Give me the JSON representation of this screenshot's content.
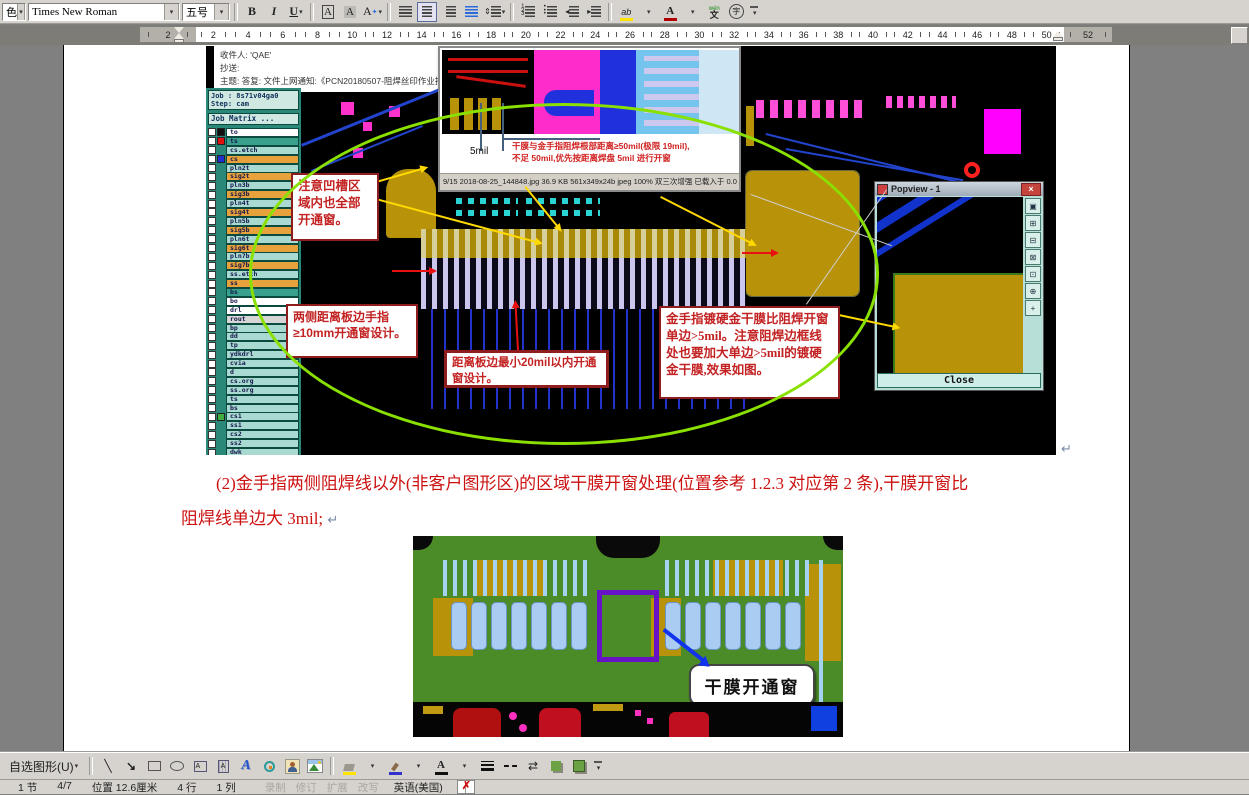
{
  "format_toolbar": {
    "style_partial": "色",
    "font_name": "Times New Roman",
    "font_size": "五号"
  },
  "icons": {
    "dropdown": "▾",
    "bold": "B",
    "italic": "I",
    "underline": "U",
    "char_border": "A",
    "char_shading": "A",
    "char_scale": "A",
    "highlight": "ab",
    "font_color": "A",
    "pinyin_top": "wén",
    "pinyin_bottom": "文",
    "enclose": "字",
    "line": "╲",
    "arrow": "↘",
    "wordart": "A",
    "arrow_style": "⇄",
    "close_x": "×",
    "spell_x": "✗",
    "para_mark": "↵"
  },
  "ruler": {
    "left_numbers": [
      "2"
    ],
    "numbers": [
      "2",
      "4",
      "6",
      "8",
      "10",
      "12",
      "14",
      "16",
      "18",
      "20",
      "22",
      "24",
      "26",
      "28",
      "30",
      "32",
      "34",
      "36",
      "38",
      "40",
      "42",
      "44",
      "46",
      "48",
      "50"
    ],
    "right_numbers": [
      "52"
    ]
  },
  "document": {
    "email": {
      "to_line": "收件人:    'QAE'",
      "cc_line": "抄送:",
      "subject_line": "主题:    答复: 文件上网通知:《PCN20180507-阻焊丝印作业指导书》《PCN2018050"
    },
    "cam": {
      "job_line": "Job : 8s71v04ga0",
      "step_line": "Step: cam",
      "matrix_button": "Job Matrix ...",
      "layers": [
        {
          "name": "to",
          "bg": "#ffffff",
          "sq": "#101010"
        },
        {
          "name": "ts",
          "bg": "#38a08c",
          "sq": "#e01010"
        },
        {
          "name": "cs.etch",
          "bg": "#a9dad2"
        },
        {
          "name": "cs",
          "bg": "#e8a23c",
          "sq": "#2030d0"
        },
        {
          "name": "pln2t",
          "bg": "#a9dad2"
        },
        {
          "name": "sig2t",
          "bg": "#e8a23c"
        },
        {
          "name": "pln3b",
          "bg": "#a9dad2"
        },
        {
          "name": "sig3b",
          "bg": "#e8a23c"
        },
        {
          "name": "pln4t",
          "bg": "#a9dad2"
        },
        {
          "name": "sig4t",
          "bg": "#e8a23c"
        },
        {
          "name": "pln5b",
          "bg": "#a9dad2"
        },
        {
          "name": "sig5b",
          "bg": "#e8a23c"
        },
        {
          "name": "pln6t",
          "bg": "#a9dad2"
        },
        {
          "name": "sig6t",
          "bg": "#e8a23c"
        },
        {
          "name": "pln7b",
          "bg": "#a9dad2"
        },
        {
          "name": "sig7b",
          "bg": "#e8a23c"
        },
        {
          "name": "ss.etch",
          "bg": "#a9dad2"
        },
        {
          "name": "ss",
          "bg": "#e8a23c"
        },
        {
          "name": "bs",
          "bg": "#38a08c"
        },
        {
          "name": "bo",
          "bg": "#ffffff"
        },
        {
          "name": "drl",
          "bg": "#ffffff"
        },
        {
          "name": "rout",
          "bg": "#d6d6d6"
        },
        {
          "name": "bp",
          "bg": "#a9dad2"
        },
        {
          "name": "dd",
          "bg": "#a9dad2"
        },
        {
          "name": "tp",
          "bg": "#a9dad2"
        },
        {
          "name": "ydkdrl",
          "bg": "#a9dad2"
        },
        {
          "name": "cvia",
          "bg": "#a9dad2"
        },
        {
          "name": "d",
          "bg": "#a9dad2"
        },
        {
          "name": "cs.org",
          "bg": "#a9dad2"
        },
        {
          "name": "ss.org",
          "bg": "#a9dad2"
        },
        {
          "name": "ts",
          "bg": "#a9dad2"
        },
        {
          "name": "bs",
          "bg": "#a9dad2"
        },
        {
          "name": "cs1",
          "bg": "#a9dad2",
          "sq": "#3fae3f"
        },
        {
          "name": "ss1",
          "bg": "#a9dad2"
        },
        {
          "name": "cs2",
          "bg": "#a9dad2"
        },
        {
          "name": "ss2",
          "bg": "#a9dad2"
        },
        {
          "name": "dwk",
          "bg": "#a9dad2"
        }
      ]
    },
    "inset_viewer": {
      "dim_label": "5mil",
      "note_line1": "干膜与金手指阻焊根部距离≥50mil(极限 19mil),",
      "note_line2": "不足 50mil,优先按距离焊盘 5mil 进行开窗",
      "status_line": "9/15  2018-08-25_144848.jpg  36.9 KB  561x349x24b jpeg  100%  双三次增强  已载入于 0.0 秒"
    },
    "popview": {
      "title": "Popview - 1",
      "close_label": "Close",
      "tools": [
        "▣",
        "⊞",
        "⊟",
        "⊠",
        "⊡",
        "⊕",
        "+"
      ]
    },
    "annotations": {
      "notch": "注意凹槽区域内也全部开通窗。",
      "sides": "两侧距离板边手指≥10mm开通窗设计。",
      "edge": "距离板边最小20mil以内开通窗设计。",
      "gold": "金手指镀硬金干膜比阻焊开窗单边>5mil。注意阻焊边框线处也要加大单边>5mil的镀硬金干膜,效果如图。"
    },
    "paragraph": {
      "line1": "(2)金手指两侧阻焊线以外(非客户图形区)的区域干膜开窗处理(位置参考 1.2.3 对应第 2 条),干膜开窗比",
      "line2": "阻焊线单边大 3mil;"
    },
    "image2_label": "干膜开通窗"
  },
  "drawing_toolbar": {
    "autoshapes_label": "自选图形(U)"
  },
  "status_bar": {
    "cells": [
      "1 节",
      "4/7",
      "位置 12.6厘米",
      "4 行",
      "1 列"
    ],
    "modes": [
      "录制",
      "修订",
      "扩展",
      "改写"
    ],
    "language": "英语(美国)"
  }
}
